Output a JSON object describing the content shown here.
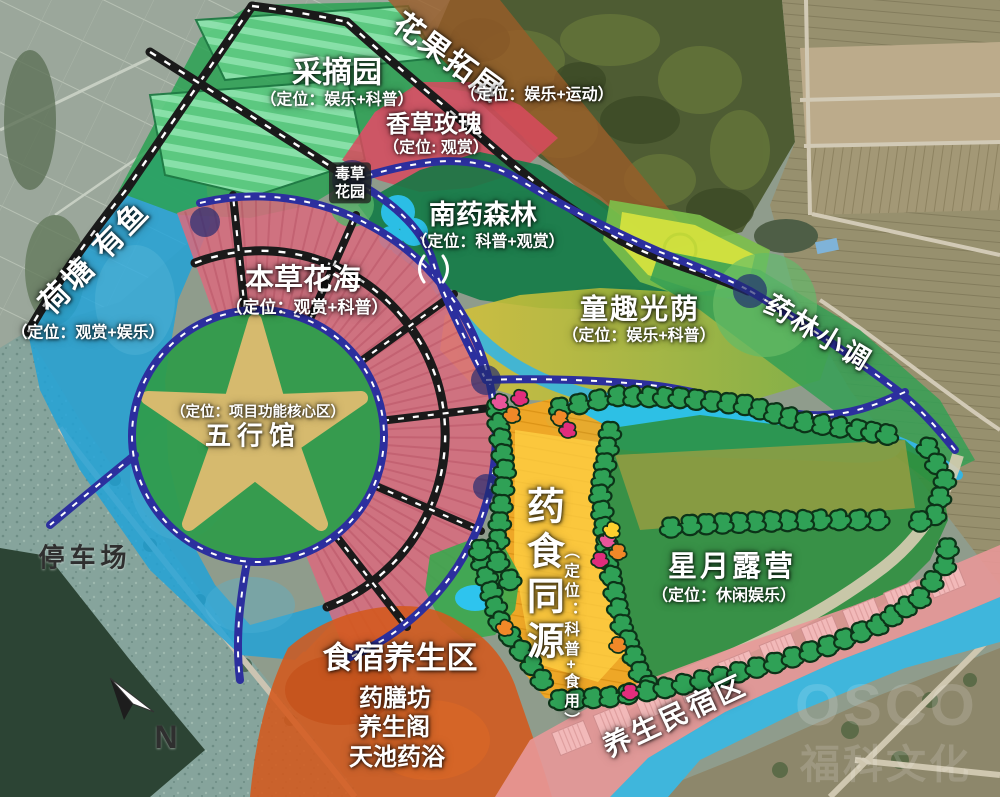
{
  "zones": {
    "caizhaiyuan": {
      "name": "采摘园",
      "positioning": "（定位：娱乐+科普）"
    },
    "huaguotuozhan": {
      "name": "花果拓展",
      "positioning": "（定位：娱乐+运动）"
    },
    "xiangcaomeigui": {
      "name": "香草玫瑰",
      "positioning": "（定位: 观赏）"
    },
    "ducaohuayuan": {
      "line1": "毒草",
      "line2": "花园"
    },
    "nanyaosenlin": {
      "name": "南药森林",
      "positioning": "（定位：科普+观赏）"
    },
    "hetangyouyu": {
      "name": "荷塘 有鱼",
      "positioning": "（定位：观赏+娱乐）"
    },
    "bencaohuahai": {
      "name": "本草花海",
      "positioning": "（定位：观赏+科普）"
    },
    "wuxingguan": {
      "name": "五行馆",
      "positioning": "（定位：项目功能核心区）"
    },
    "tongquguangyin": {
      "name": "童趣光荫",
      "positioning": "（定位：娱乐+科普）"
    },
    "yaolinxiaodiao": {
      "name": "药林小调"
    },
    "tingchechang": {
      "name": "停车场"
    },
    "yaoshitongyuan": {
      "name": "药食同源",
      "positioning": "（定位：科普+食用）"
    },
    "xingyueluying": {
      "name": "星月露营",
      "positioning": "（定位：休闲娱乐）"
    },
    "shisuyangsheng": {
      "name": "食宿养生区",
      "items": [
        "药膳坊",
        "养生阁",
        "天池药浴"
      ]
    },
    "yangshengminsu": {
      "name": "养生民宿区"
    }
  },
  "compass": {
    "north_label": "N"
  },
  "watermark": {
    "logo": "OSCO",
    "name": "福科文化"
  },
  "colors": {
    "road_black": "#1a1a1a",
    "road_blue": "#2c2f9e",
    "pond_zone_blue": "#1fa3da",
    "picking_green": "#2ba254",
    "herb_rose_red": "#d84a5e",
    "fruit_brown": "#9a5c28",
    "south_med_forest": "#0f7a44",
    "flower_sea_pink": "#db6b7e",
    "star_tan": "#d6ba6e",
    "core_circle_green": "#2f9b49",
    "kids_yellow": "#d8c238",
    "medicine_food_orange": "#f6a81e",
    "camping_green": "#2c8f3d",
    "dining_orange": "#d4591c",
    "homestay_pink": "#e89898",
    "lake_cyan": "#28c2ea"
  }
}
